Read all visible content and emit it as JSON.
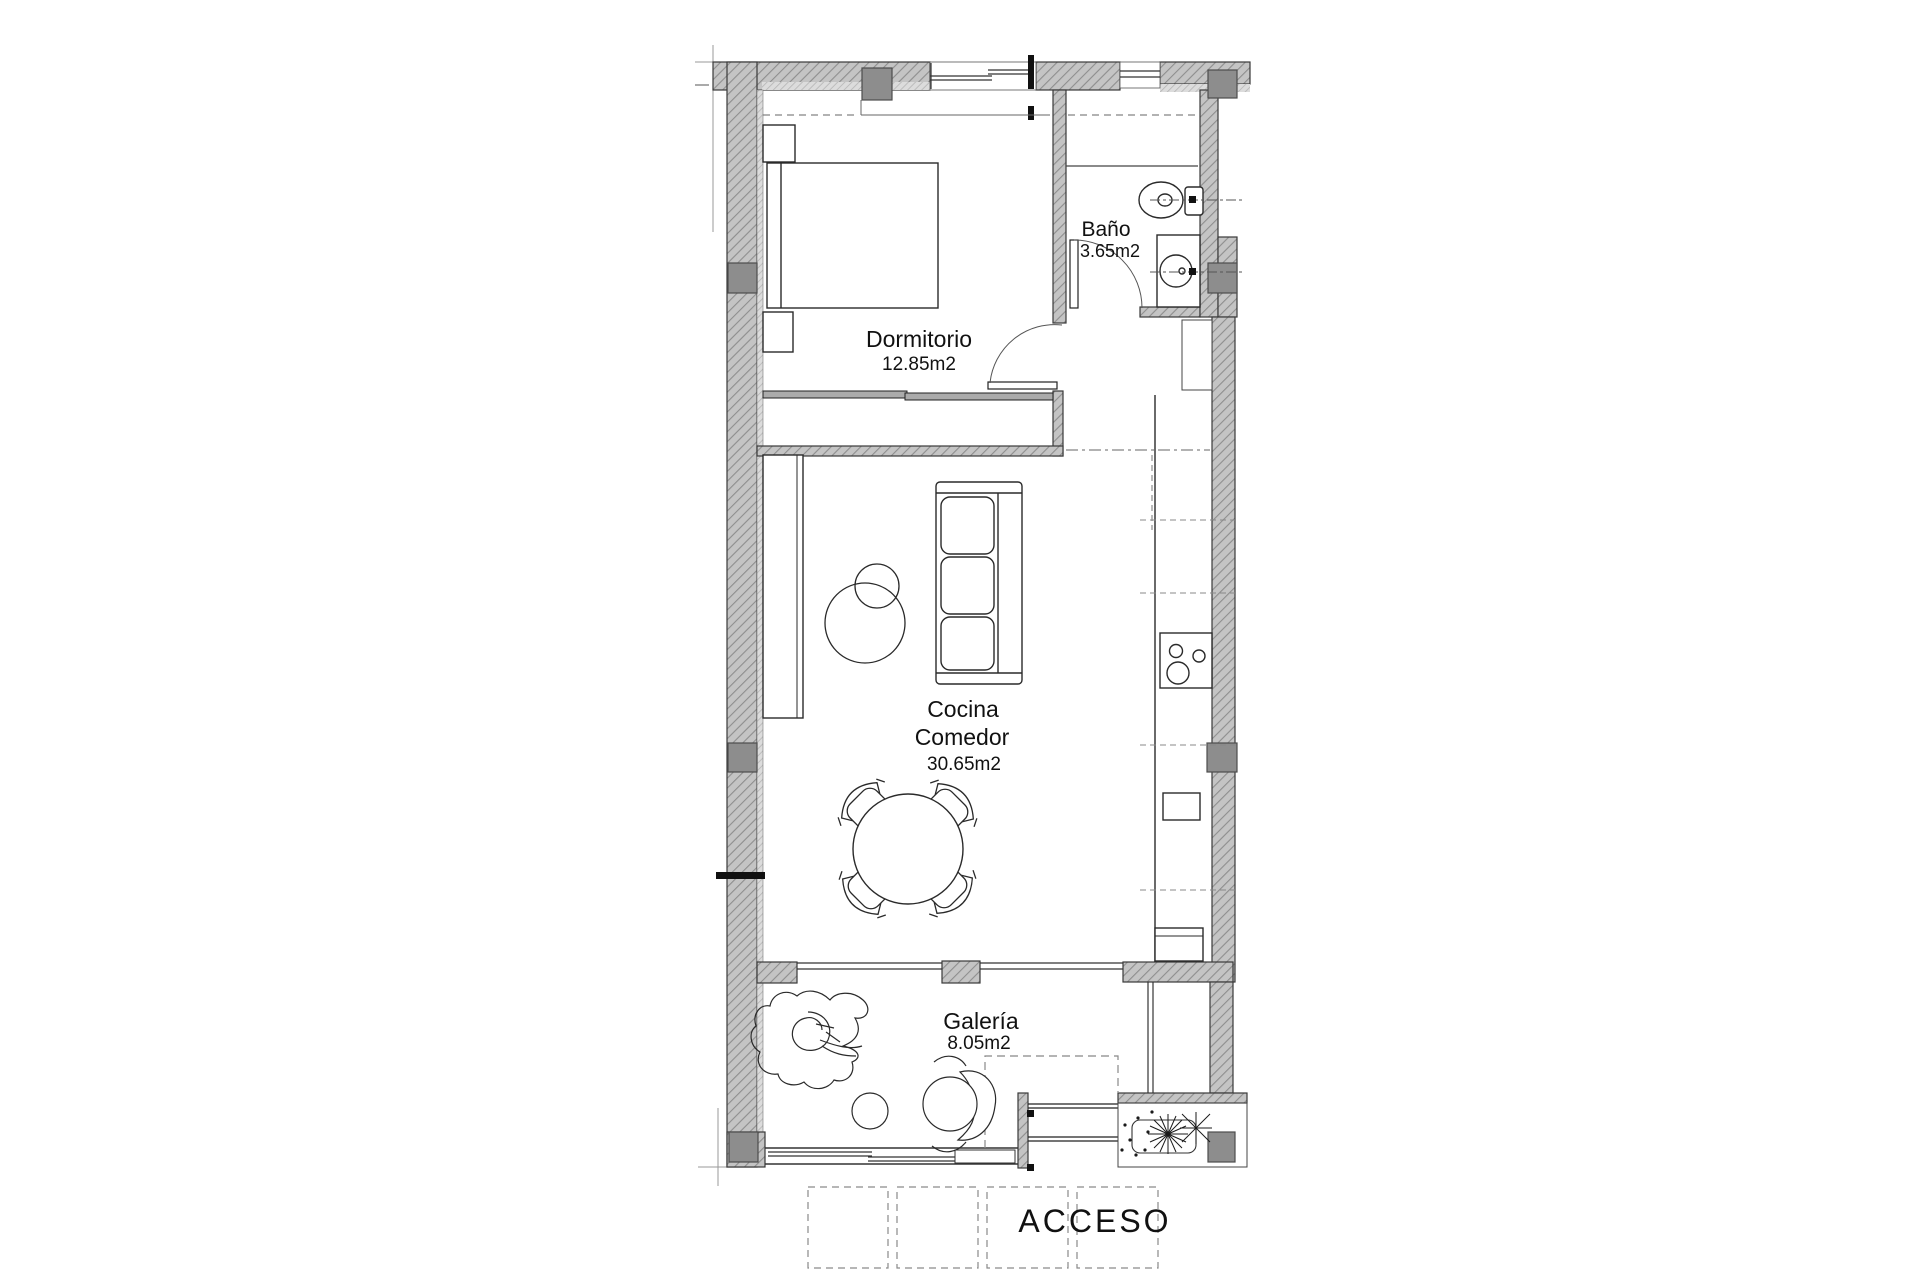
{
  "plan": {
    "rooms": [
      {
        "name": "Dormitorio",
        "area": "12.85m2"
      },
      {
        "name": "Baño",
        "area": "3.65m2"
      },
      {
        "name": "Cocina",
        "subname": "Comedor",
        "area": "30.65m2"
      },
      {
        "name": "Galería",
        "area": "8.05m2"
      }
    ],
    "entrance_label": "ACCESO"
  },
  "colors": {
    "background": "#ffffff",
    "wall_hatch_base": "#c4c4c4",
    "wall_hatch_line": "#8e8e8e",
    "finish_hatch_base": "#dcdcdc",
    "column_fill": "#8d8d8d",
    "outline": "#333333",
    "furniture_line": "#2a2a2a",
    "reference_line": "#999999",
    "text": "#111111"
  }
}
